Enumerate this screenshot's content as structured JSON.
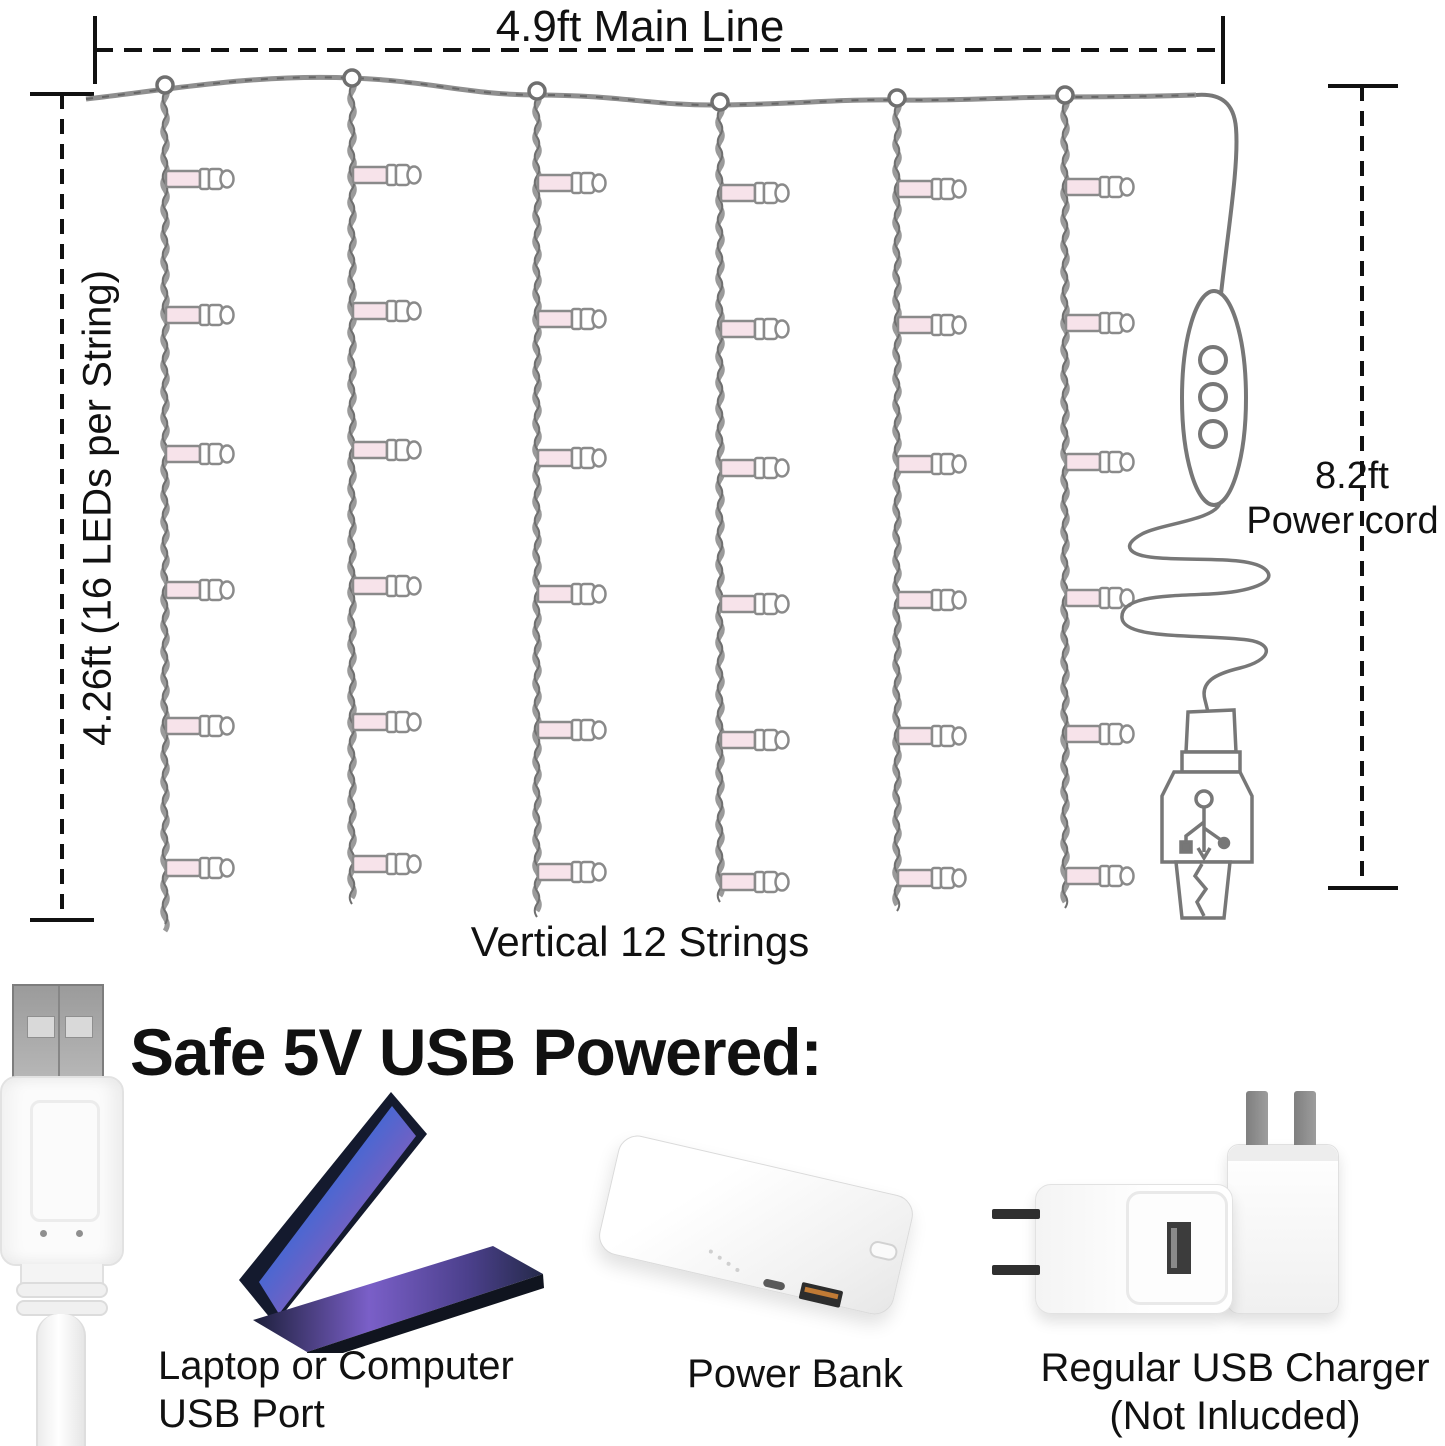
{
  "diagram": {
    "main_line_label": "4.9ft Main Line",
    "vertical_dim_label": "4.26ft (16 LEDs per String)",
    "power_cord_dim_value": "8.2ft",
    "power_cord_dim_caption": "Power cord",
    "strings_label": "Vertical 12 Strings",
    "strings": {
      "count_shown": 6,
      "xs": [
        165,
        352,
        537,
        720,
        897,
        1065
      ],
      "attach_ys": [
        86,
        79,
        92,
        103,
        99,
        96
      ],
      "bottoms": [
        932,
        906,
        924,
        908,
        918,
        914
      ],
      "bulb_rows": [
        179,
        315,
        454,
        590,
        726,
        868
      ],
      "row_offsets": [
        0,
        -4,
        4,
        14,
        10,
        8
      ],
      "bulbs_per_string": 6
    },
    "colors": {
      "wire": "#9a9a9a",
      "wire_dark": "#6f6f6f",
      "bulb_fill": "#f7e3ea",
      "bulb_stroke": "#8a8a8a",
      "outline": "#777777",
      "dim_line": "#111111"
    }
  },
  "power_section": {
    "heading": "Safe 5V USB Powered:",
    "items": [
      {
        "id": "laptop",
        "label_line1": "Laptop or Computer",
        "label_line2": "USB Port"
      },
      {
        "id": "power-bank",
        "label_line1": "Power Bank",
        "label_line2": ""
      },
      {
        "id": "usb-charger",
        "label_line1": "Regular USB Charger",
        "label_line2": "(Not Inlucded)"
      }
    ]
  }
}
